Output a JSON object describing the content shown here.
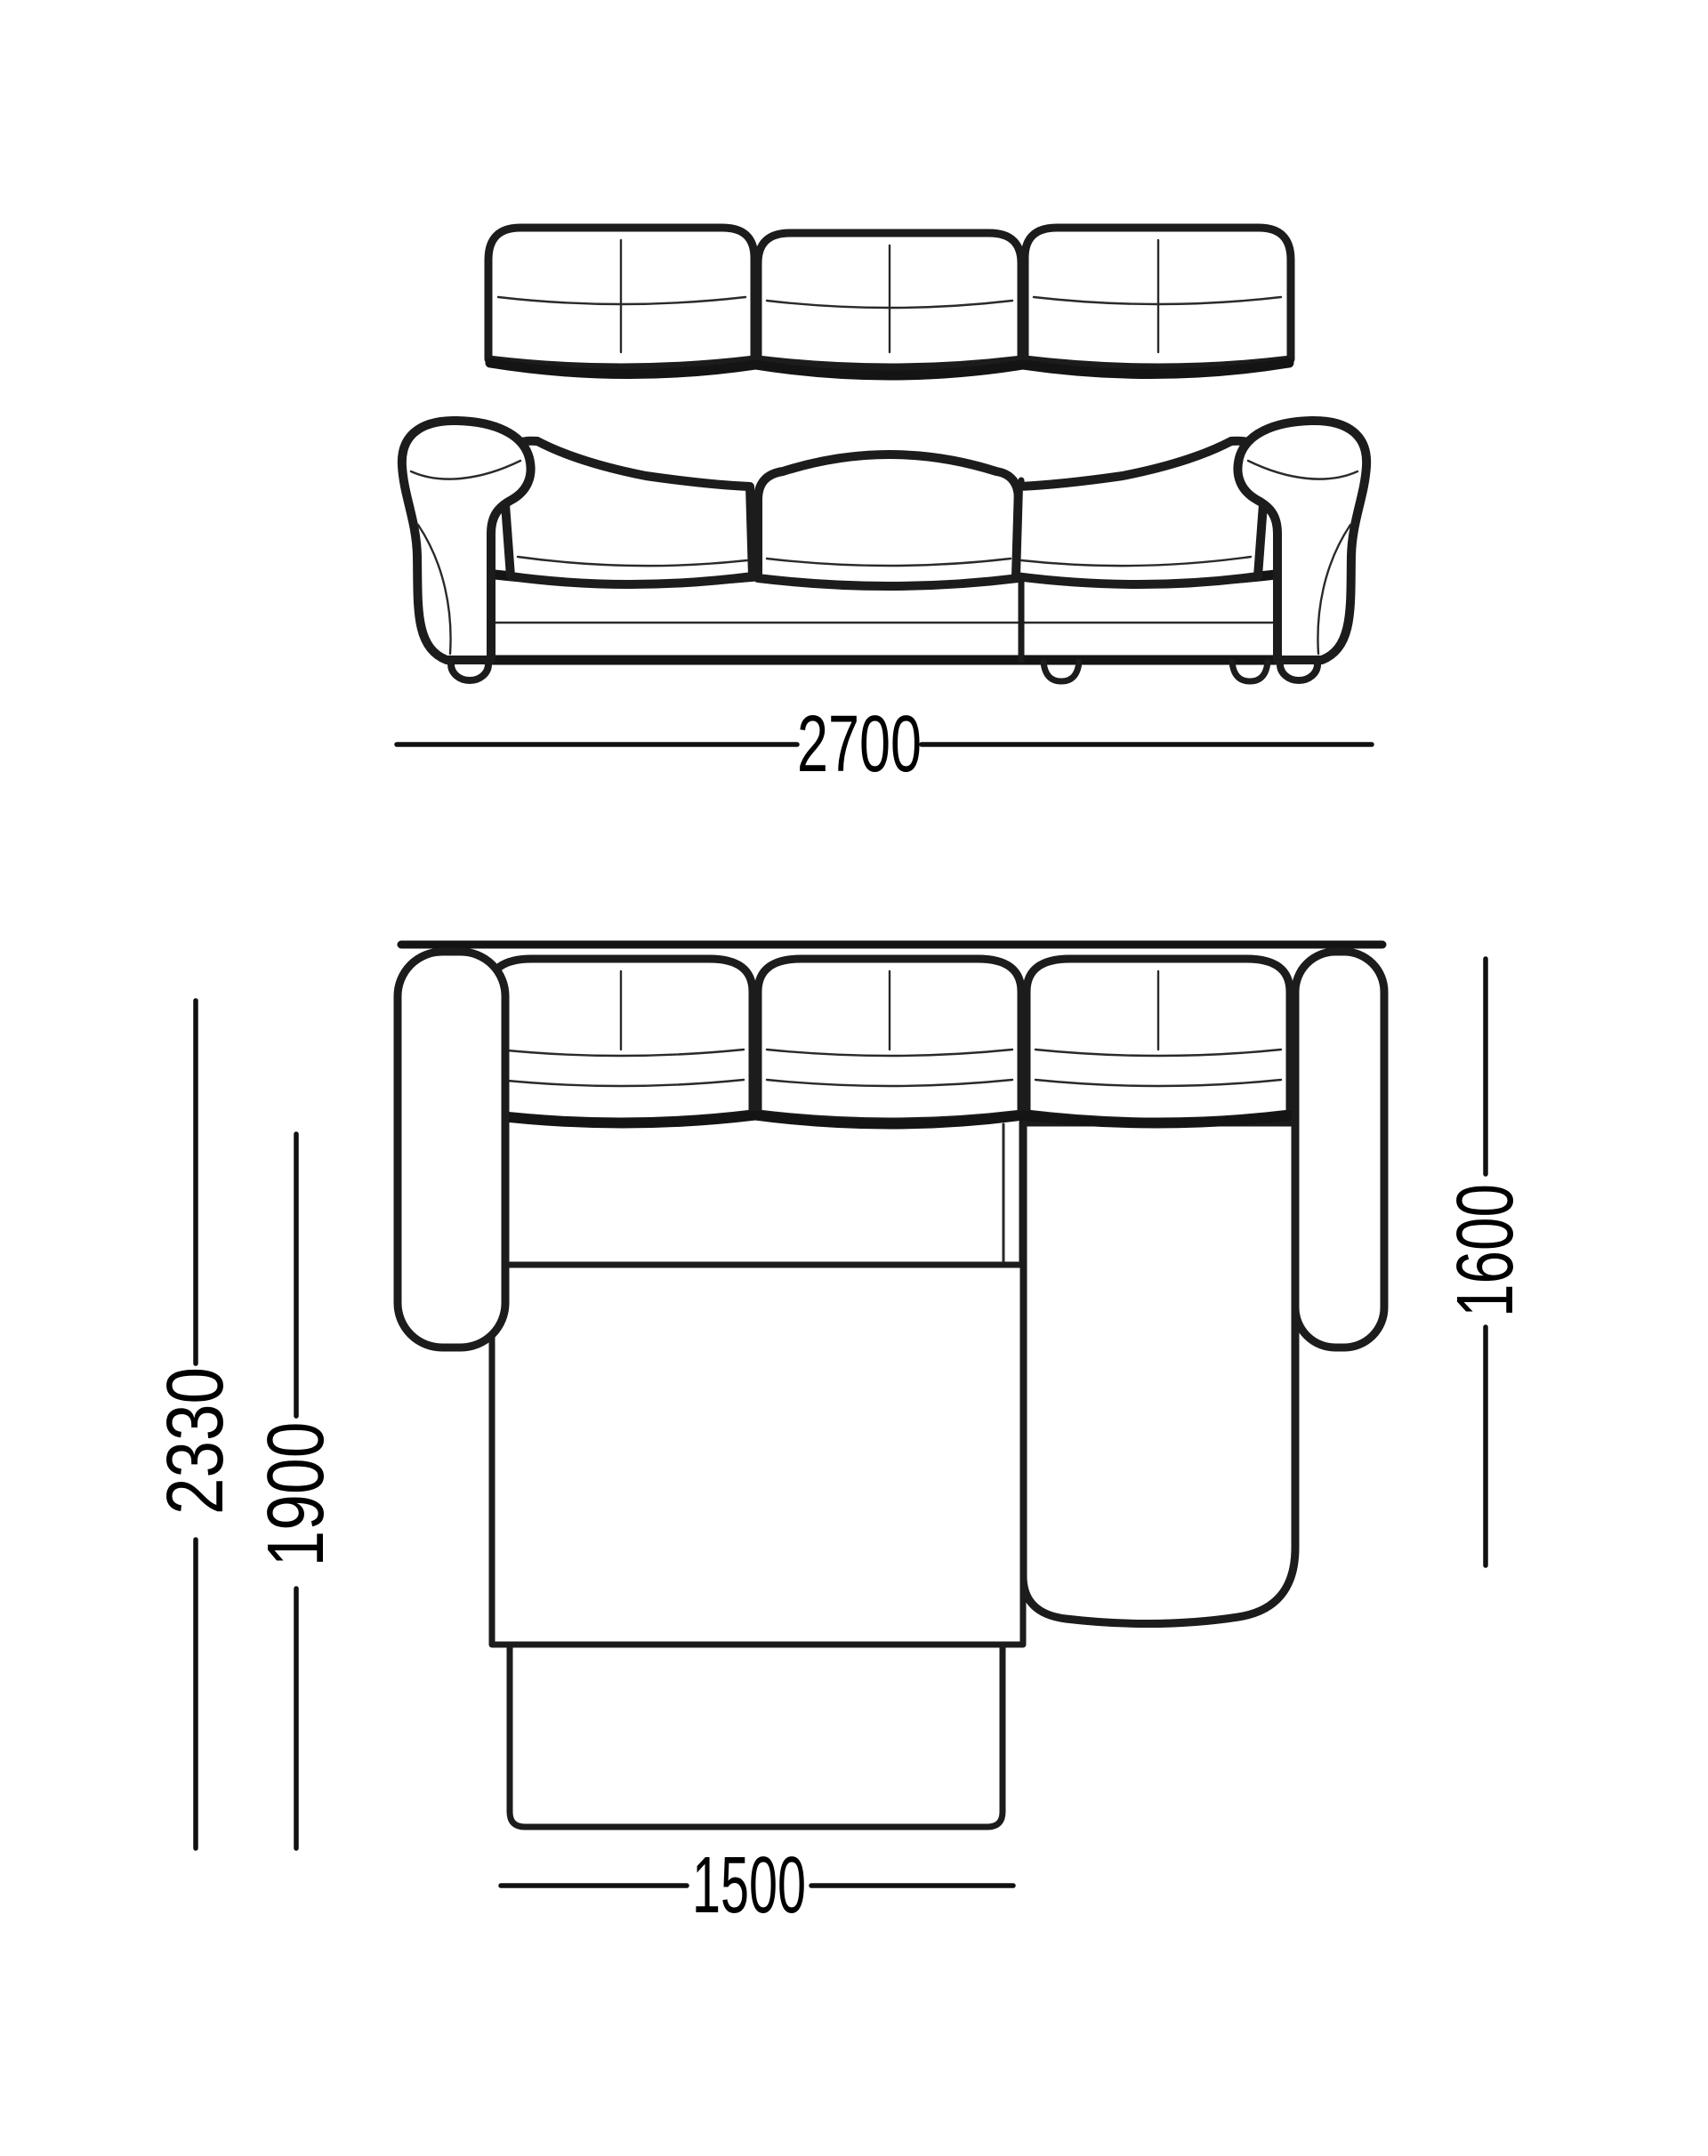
{
  "diagram": {
    "kind": "sofa-dimension-drawing",
    "background_color": "#ffffff",
    "line_color": "#1c1c1c",
    "label_color": "#000000"
  },
  "dimensions": {
    "total_width": "2700",
    "total_depth": "2330",
    "bed_depth": "1900",
    "bed_width": "1500",
    "chaise_depth": "1600"
  }
}
